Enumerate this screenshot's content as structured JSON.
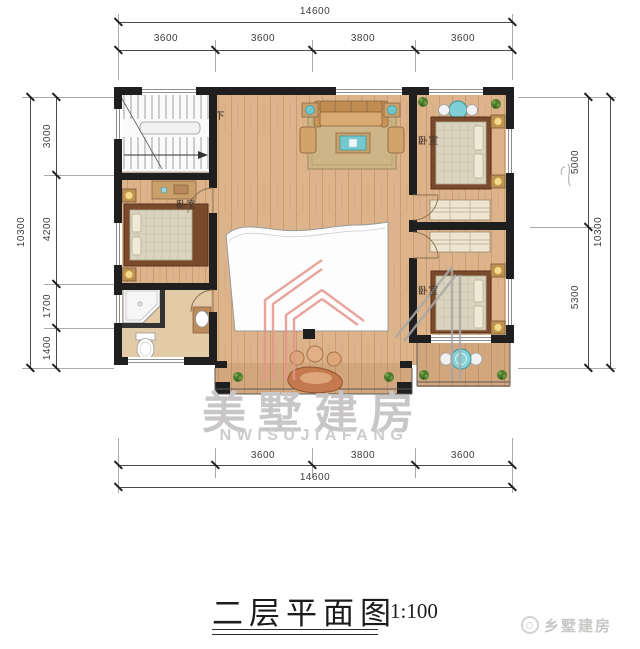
{
  "title": {
    "text": "二层平面图",
    "scale": "1:100"
  },
  "watermark": {
    "cn": "美墅建房",
    "en": "NWISUJIAFANG"
  },
  "brand": {
    "name": "乡墅建房"
  },
  "plan": {
    "labels": {
      "bedroom": "卧室",
      "stairs_down": "下"
    }
  },
  "dimensions": {
    "top": {
      "total": "14600",
      "segments": [
        "3600",
        "3600",
        "3800",
        "3600"
      ]
    },
    "bottom": {
      "total": "14600",
      "segments": [
        "3600",
        "3800",
        "3600"
      ]
    },
    "left": {
      "total": "10300",
      "segments": [
        "3000",
        "4200",
        "1700",
        "1400"
      ]
    },
    "right": {
      "total": "10300",
      "segments": [
        "5000",
        "5300"
      ]
    }
  },
  "colors": {
    "floor_wood": "#dcb38a",
    "wall": "#1f1f1f",
    "accent_teal": "#74c9cf",
    "watermark_pink": "#e5958b",
    "watermark_gray": "#a8a8a8"
  }
}
